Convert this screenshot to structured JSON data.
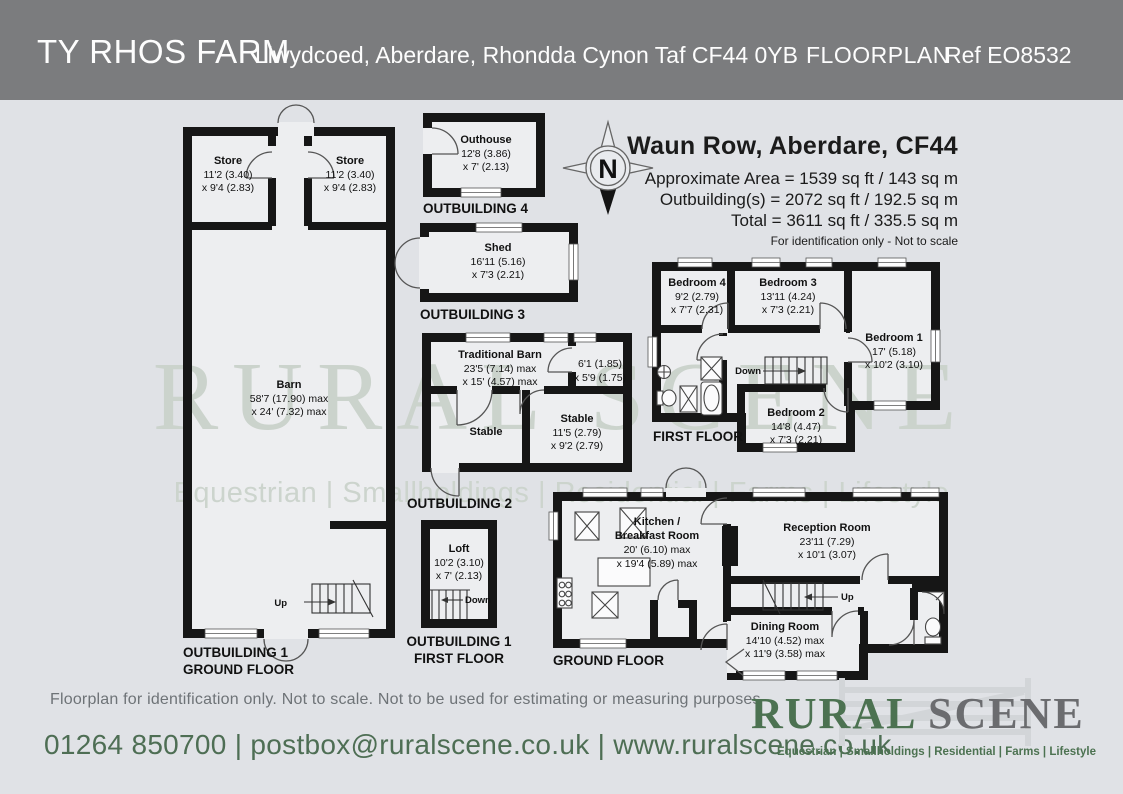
{
  "header": {
    "property_name": "TY RHOS FARM",
    "address": "Llwydcoed, Aberdare, Rhondda Cynon Taf CF44 0YB",
    "doc_type": "FLOORPLAN",
    "ref": "Ref EO8532"
  },
  "summary": {
    "title": "Waun Row, Aberdare, CF44",
    "approx_area": "Approximate Area = 1539 sq ft / 143 sq m",
    "outbuildings": "Outbuilding(s) = 2072 sq ft / 192.5 sq m",
    "total": "Total = 3611 sq ft / 335.5 sq m",
    "note": "For identification only - Not to scale"
  },
  "compass": {
    "north": "N"
  },
  "rooms": {
    "store_left": {
      "name": "Store",
      "d1": "11'2 (3.40)",
      "d2": "x 9'4 (2.83)"
    },
    "store_right": {
      "name": "Store",
      "d1": "11'2 (3.40)",
      "d2": "x 9'4 (2.83)"
    },
    "barn": {
      "name": "Barn",
      "d1": "58'7 (17.90) max",
      "d2": "x 24' (7.32) max"
    },
    "outhouse": {
      "name": "Outhouse",
      "d1": "12'8 (3.86)",
      "d2": "x 7' (2.13)"
    },
    "shed": {
      "name": "Shed",
      "d1": "16'11 (5.16)",
      "d2": "x 7'3 (2.21)"
    },
    "traditional_barn": {
      "name": "Traditional Barn",
      "d1": "23'5 (7.14) max",
      "d2": "x 15' (4.57) max"
    },
    "store_room": {
      "d1": "6'1 (1.85)",
      "d2": "x 5'9 (1.75)"
    },
    "stable_left": {
      "name": "Stable"
    },
    "stable_right": {
      "name": "Stable",
      "d1": "11'5 (2.79)",
      "d2": "x 9'2 (2.79)"
    },
    "bedroom4": {
      "name": "Bedroom 4",
      "d1": "9'2 (2.79)",
      "d2": "x 7'7 (2.31)"
    },
    "bedroom3": {
      "name": "Bedroom 3",
      "d1": "13'11 (4.24)",
      "d2": "x 7'3 (2.21)"
    },
    "bedroom1": {
      "name": "Bedroom 1",
      "d1": "17' (5.18)",
      "d2": "x 10'2 (3.10)"
    },
    "bedroom2": {
      "name": "Bedroom 2",
      "d1": "14'8 (4.47)",
      "d2": "x 7'3 (2.21)"
    },
    "loft": {
      "name": "Loft",
      "d1": "10'2 (3.10)",
      "d2": "x 7' (2.13)"
    },
    "kitchen": {
      "name1": "Kitchen /",
      "name2": "Breakfast Room",
      "d1": "20' (6.10) max",
      "d2": "x 19'4 (5.89) max"
    },
    "reception": {
      "name": "Reception Room",
      "d1": "23'11 (7.29)",
      "d2": "x 10'1 (3.07)"
    },
    "dining": {
      "name": "Dining Room",
      "d1": "14'10 (4.52) max",
      "d2": "x 11'9 (3.58) max"
    }
  },
  "floor_labels": {
    "ob1_gf_1": "OUTBUILDING 1",
    "ob1_gf_2": "GROUND FLOOR",
    "ob4": "OUTBUILDING 4",
    "ob3": "OUTBUILDING 3",
    "ob2": "OUTBUILDING 2",
    "first_floor": "FIRST FLOOR",
    "ob1_ff_1": "OUTBUILDING 1",
    "ob1_ff_2": "FIRST FLOOR",
    "ground_floor": "GROUND FLOOR"
  },
  "stairs": {
    "up": "Up",
    "down": "Down"
  },
  "watermark": {
    "brand": "RURAL SCENE",
    "tagline": "Equestrian | Smallholdings | Residential | Farms | Lifestyle"
  },
  "footer": {
    "disclaimer": "Floorplan for identification only. Not to scale. Not to be used for estimating or measuring purposes",
    "contact": "01264 850700 | postbox@ruralscene.co.uk | www.ruralscene.co.uk"
  },
  "logo": {
    "brand_left": "RURAL",
    "brand_right": " SCENE",
    "tagline": "Equestrian | Smallholdings | Residential | Farms | Lifestyle"
  },
  "colors": {
    "header_bg": "#7b7c7e",
    "page_bg": "#e0e2e6",
    "wall": "#161616",
    "brand_green": "#4c7251",
    "brand_gray": "#6b6c6f",
    "watermark": "#cbd3cc"
  }
}
